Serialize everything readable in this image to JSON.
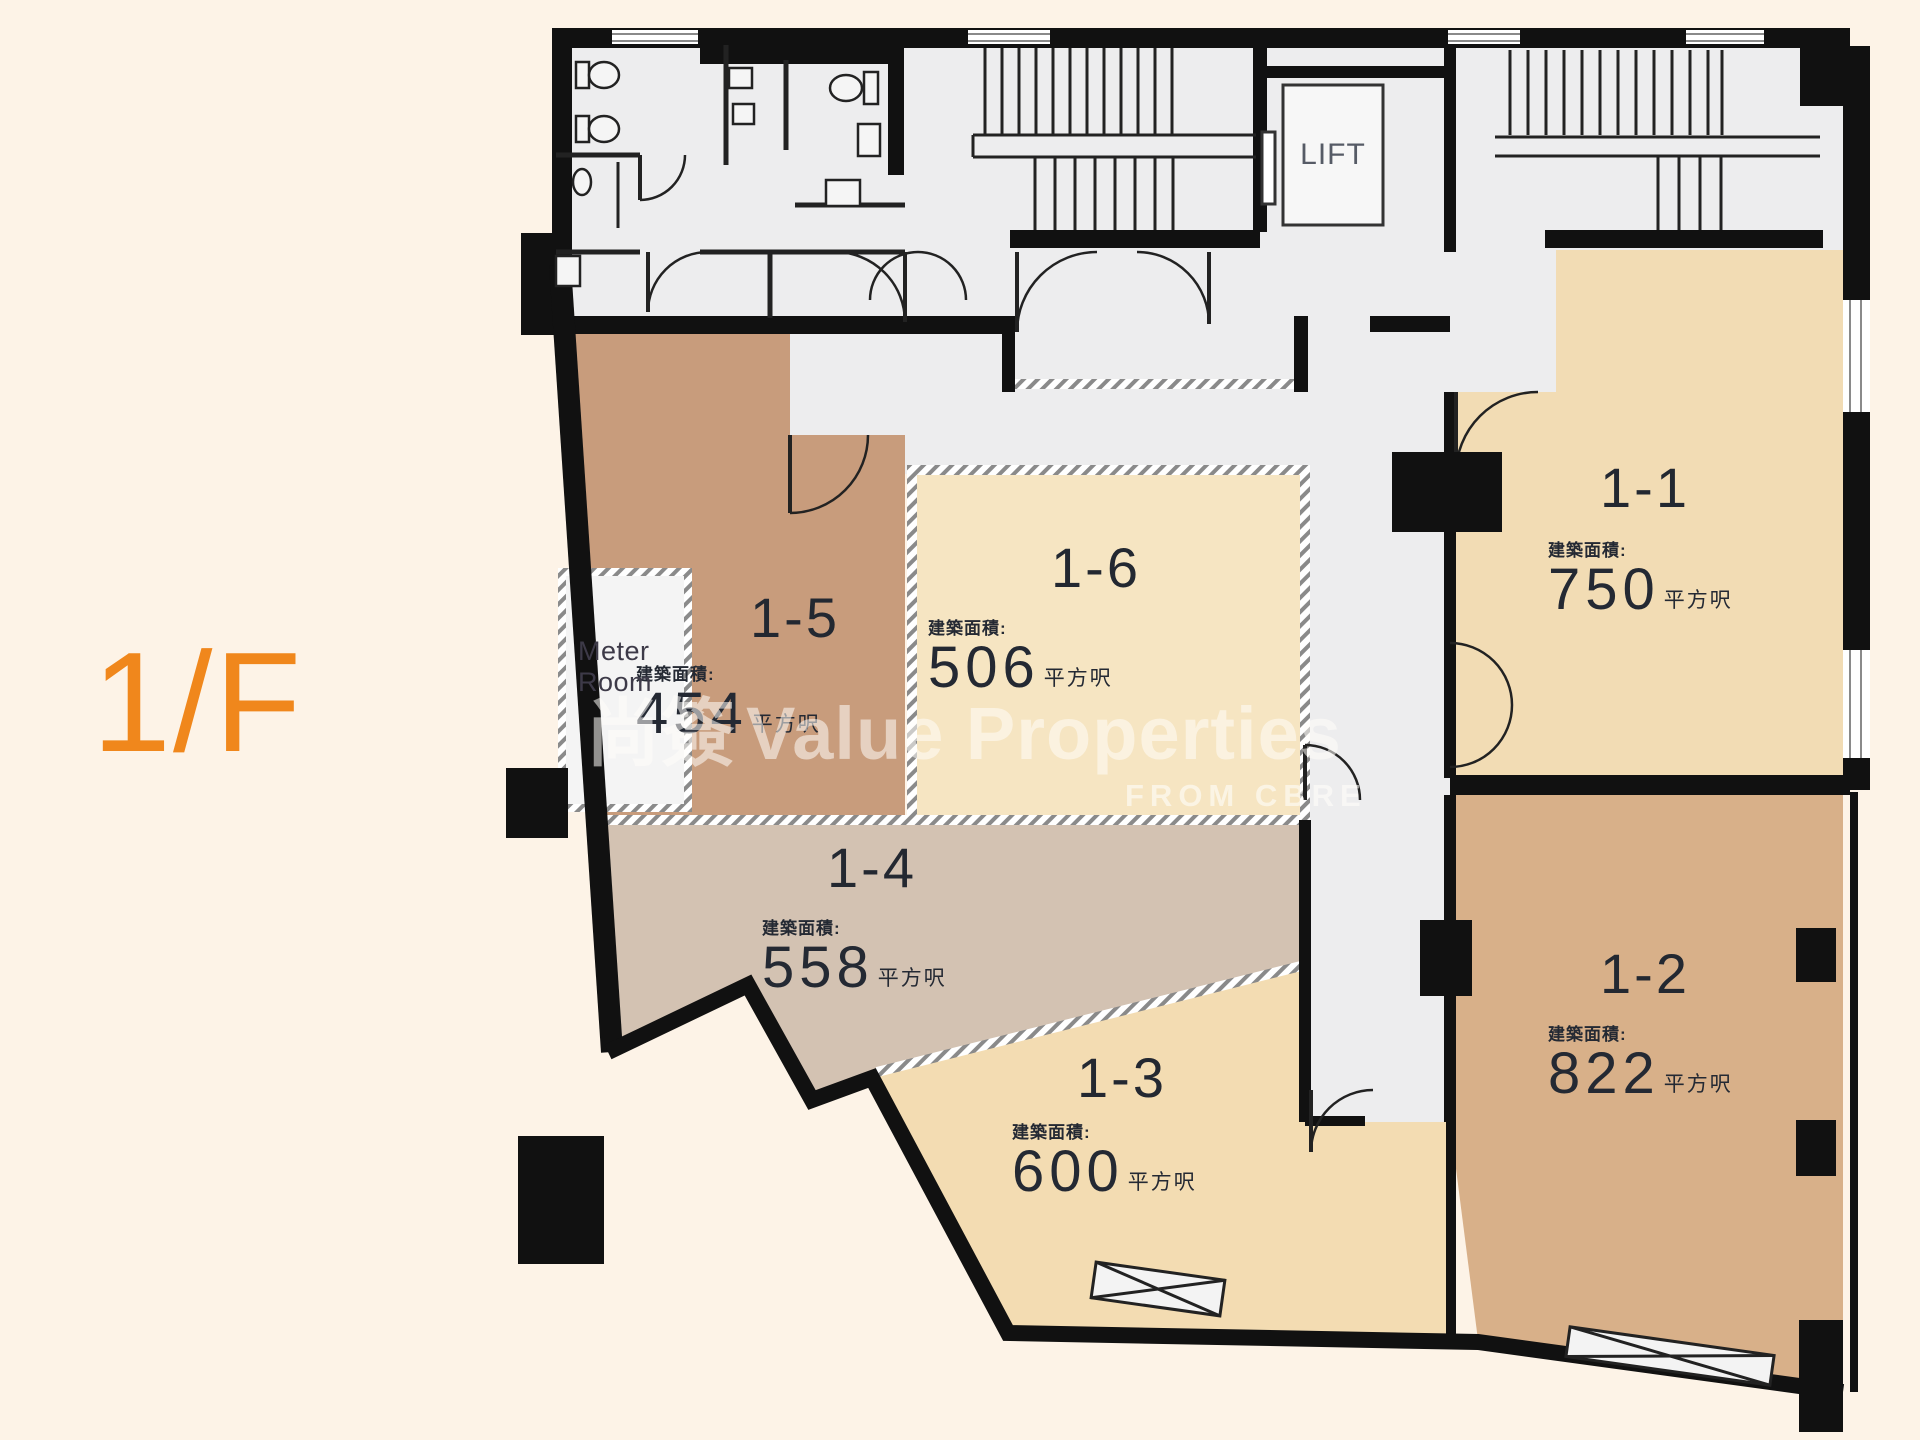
{
  "floor": {
    "label": "1/F",
    "color": "#f0871c"
  },
  "watermark": {
    "logo": "尚簽",
    "brand": "Value Properties",
    "subtitle": "FROM CBRE"
  },
  "common_area": {
    "lift_label": "LIFT",
    "meter_room": {
      "line1": "Meter",
      "line2": "Room"
    }
  },
  "labels": {
    "area_prefix": "建築面積:",
    "area_unit": "平方呎"
  },
  "units": [
    {
      "id": "1-1",
      "area": "750",
      "color": "#f2dcb4"
    },
    {
      "id": "1-2",
      "area": "822",
      "color": "#d8b089"
    },
    {
      "id": "1-3",
      "area": "600",
      "color": "#f3dcb2"
    },
    {
      "id": "1-4",
      "area": "558",
      "color": "#d3c2b2"
    },
    {
      "id": "1-5",
      "area": "454",
      "color": "#c89c7c"
    },
    {
      "id": "1-6",
      "area": "506",
      "color": "#f6e5c2"
    }
  ],
  "colors": {
    "background": "#fdf3e7",
    "walls": "#111111",
    "common_floor": "#ededee",
    "accent_orange": "#f0871c",
    "watermark": "#ffffff"
  }
}
